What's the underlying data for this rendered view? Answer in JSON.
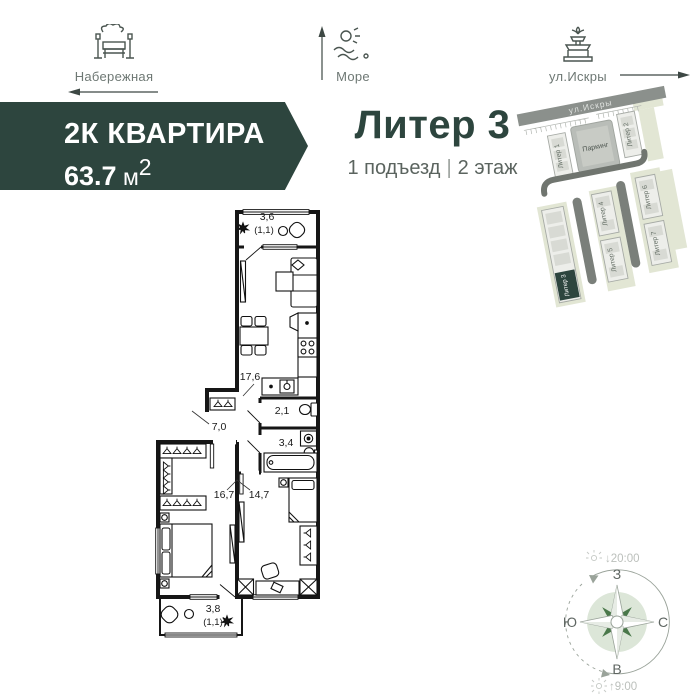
{
  "landmarks": {
    "embankment": {
      "label": "Набережная"
    },
    "sea": {
      "label": "Море"
    },
    "street": {
      "label": "ул.Искры"
    }
  },
  "badge": {
    "type_label": "2К КВАРТИРА",
    "area_value": "63.7",
    "area_unit": " м",
    "area_sup": "2"
  },
  "header": {
    "title": "Литер 3",
    "entrance": "1 подъезд",
    "divider": "|",
    "floor": "2 этаж"
  },
  "site_plan": {
    "street": "ул.Искры",
    "parking": "Паркинг",
    "buildings": [
      "Литер 1",
      "Литер 2",
      "Литер 3",
      "Литер 4",
      "Литер 5",
      "Литер 6",
      "Литер 7"
    ],
    "highlighted": "Литер 3",
    "highlight_color": "#2d453e"
  },
  "floor_plan": {
    "rooms": [
      {
        "name": "balcony-top",
        "area": "3,6",
        "reduced": "(1,1)"
      },
      {
        "name": "kitchen-living",
        "area": "17,6"
      },
      {
        "name": "hallway",
        "area": "7,0"
      },
      {
        "name": "wc",
        "area": "2,1"
      },
      {
        "name": "bathroom",
        "area": "3,4"
      },
      {
        "name": "bedroom-1",
        "area": "16,7"
      },
      {
        "name": "bedroom-2",
        "area": "14,7"
      },
      {
        "name": "balcony-bottom",
        "area": "3,8",
        "reduced": "(1,1)"
      }
    ]
  },
  "compass": {
    "top": "З",
    "right": "С",
    "left": "Ю",
    "bottom": "В",
    "sunset_arrow": "↓",
    "sunset": "20:00",
    "sunrise_arrow": "↑",
    "sunrise": "9:00"
  }
}
